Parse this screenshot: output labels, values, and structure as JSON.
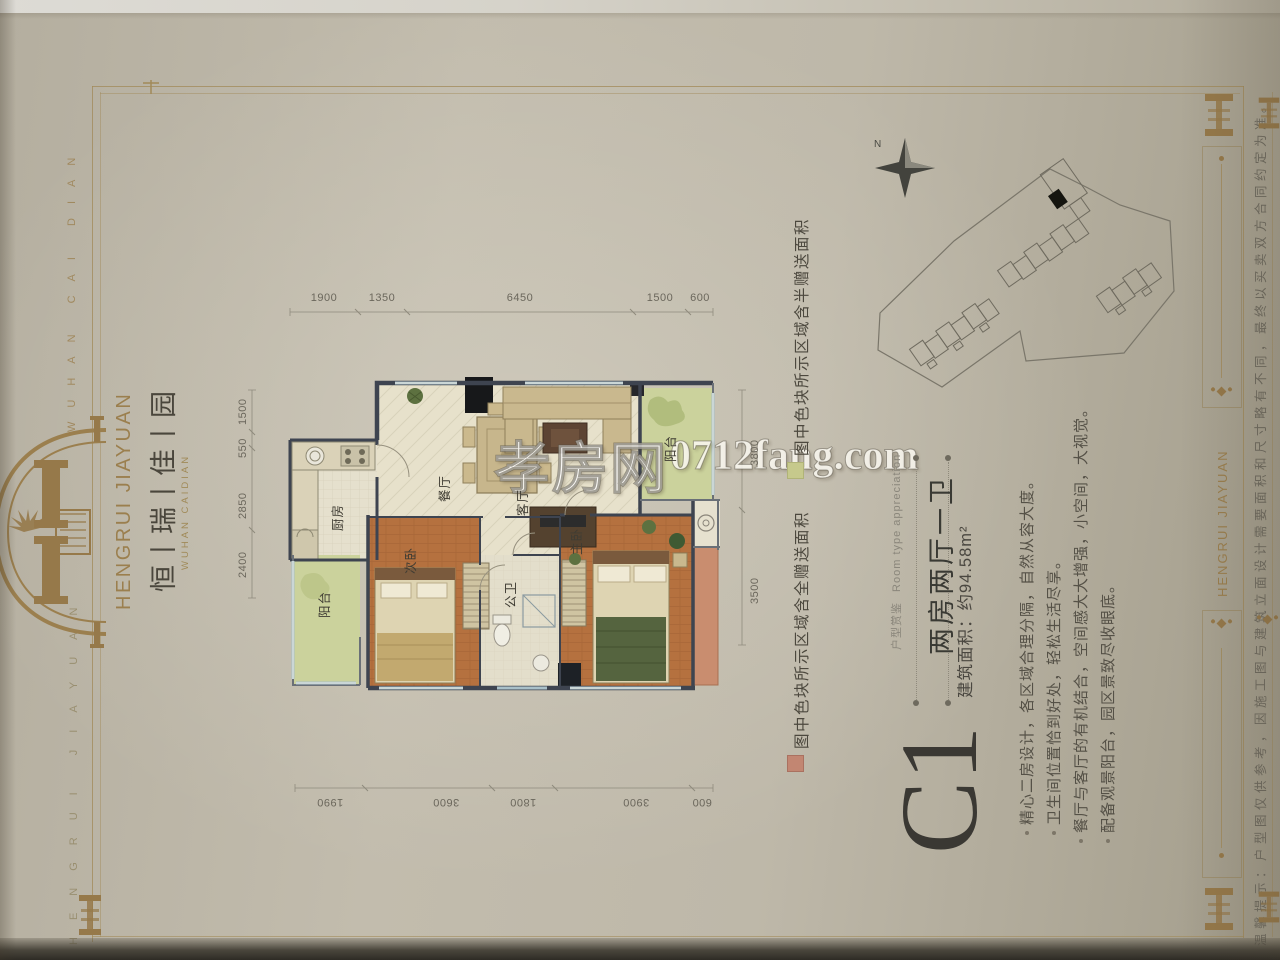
{
  "watermark": {
    "site_name": "孝房网",
    "site_url": "0712fang.com"
  },
  "brand": {
    "name_en": "HENGRUI JIAYUAN",
    "name_cn": "恒丨瑞丨佳丨园",
    "subtitle": "WUHAN CAIDIAN",
    "edge_text_top": "WUHAN CAI DIAN",
    "edge_text_bottom": "HENGRUI JIAYUAN"
  },
  "unit": {
    "code": "C1",
    "section_label_cn": "户型赏鉴",
    "section_label_en": "Room type appreciation",
    "layout_type": "两房两厅一卫",
    "area": "建筑面积：约94.58m²",
    "features": [
      "精心二房设计，各区域合理分隔，自然从容大度。",
      "卫生间位置恰到好处，轻松生活尽享。",
      "餐厅与客厅的有机结合，空间感大大增强，小空间，大视觉。",
      "配备观景阳台，园区景致尽收眼底。"
    ]
  },
  "legend": {
    "full_text": "图中色块所示区域含全赠送面积",
    "full_color": "#c28672",
    "half_text": "图中色块所示区域含半赠送面积",
    "half_color": "#c6c98c"
  },
  "plan": {
    "dims_top": [
      "1900",
      "1350",
      "6450",
      "1500",
      "600"
    ],
    "dims_bottom": [
      "1990",
      "3600",
      "1800",
      "3900",
      "600"
    ],
    "dims_left": [
      "1500",
      "550",
      "2850",
      "2400"
    ],
    "dims_right": [
      "3800",
      "3500"
    ],
    "rooms": {
      "dining": "餐厅",
      "living": "客厅",
      "kitchen": "厨房",
      "bedroom2": "次卧",
      "master": "主卧",
      "bath": "公卫",
      "balcony_left": "阳台",
      "balcony_top": "阳台"
    }
  },
  "siteplan": {
    "north_label": "N"
  },
  "sidebar": {
    "brand": "HENGRUI JIAYUAN",
    "disclaimer": "温馨提示：户型图仅供参考，因施工图与建筑立面设计需要面积和尺寸略有不同，最终以买卖双方合同约定为准。"
  }
}
